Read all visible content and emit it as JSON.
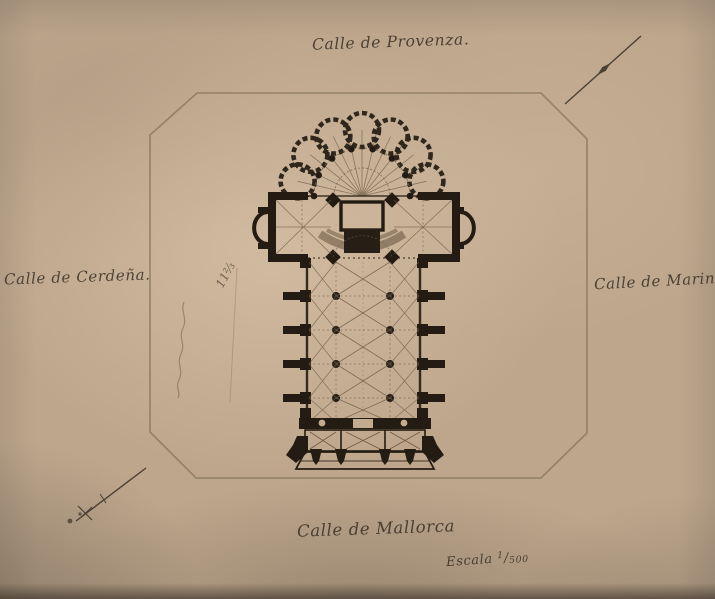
{
  "streets": {
    "top": "Calle de Provenza.",
    "left": "Calle de Cerdeña.",
    "right": "Calle de Marina",
    "bottom": "Calle de Mallorca"
  },
  "scale": {
    "label": "Escala",
    "numerator": "1",
    "slash": "/",
    "denominator": "500"
  },
  "pencil": {
    "fraction": "11⅔"
  },
  "colors": {
    "paper": "#bda68c",
    "ink": "#241c12",
    "frame_line": "#8b7963",
    "script_text": "#3c3328",
    "pencil_mark": "#6f6152"
  }
}
